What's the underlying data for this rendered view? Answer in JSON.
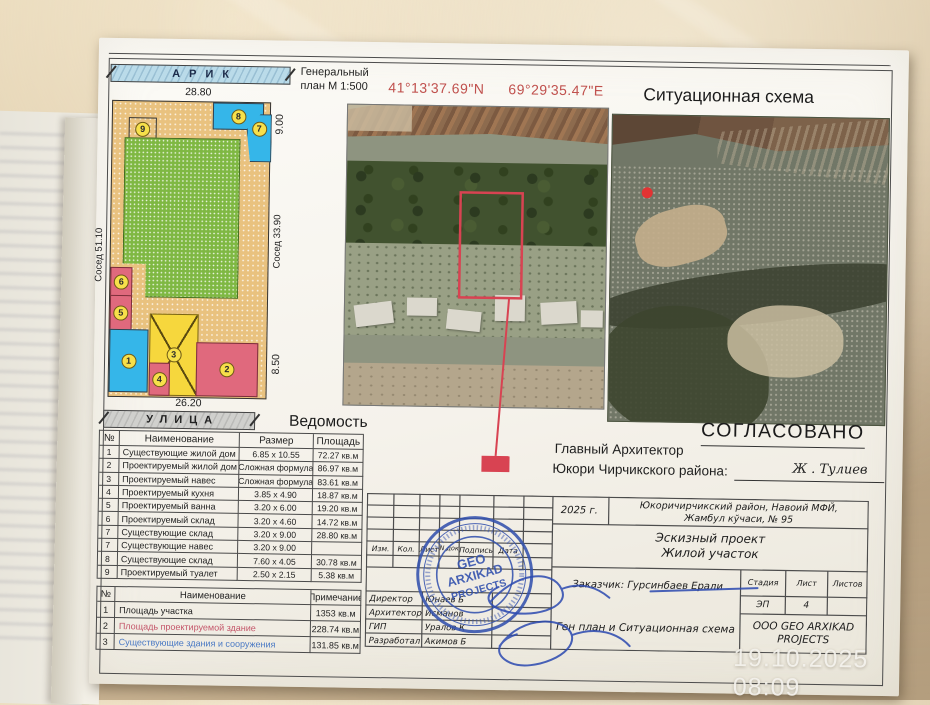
{
  "photo": {
    "timestamp": "19.10.2025 08:09"
  },
  "header": {
    "genplan_line1": "Генеральный",
    "genplan_line2": "план М 1:500",
    "coord_n": "41°13'37.69\"N",
    "coord_e": "69°29'35.47\"E",
    "situational_title": "Ситуационная схема"
  },
  "plan": {
    "canal_label": "АРИК",
    "street_label": "УЛИЦА",
    "dim_top": "28.80",
    "dim_left": "Сосед 51.10",
    "dim_right_top": "9.00",
    "dim_right_mid": "Сосед 33.90",
    "dim_right_bottom": "8.50",
    "dim_bottom": "26.20",
    "blocks": {
      "n1": "1",
      "n2": "2",
      "n3": "3",
      "n4": "4",
      "n5": "5",
      "n6": "6",
      "n7": "7",
      "n8": "8",
      "n9": "9"
    }
  },
  "tables": {
    "vedomost": {
      "title": "Ведомость",
      "headers": [
        "№",
        "Наименование",
        "Размер",
        "Площадь"
      ],
      "rows": [
        {
          "num": "1",
          "name": "Существующие жилой дом",
          "size": "6.85 x 10.55",
          "area": "72.27  кв.м"
        },
        {
          "num": "2",
          "name": "Проектируемый жилой дом",
          "size": "Сложная формула",
          "area": "86.97  кв.м"
        },
        {
          "num": "3",
          "name": "Проектируемый навес",
          "size": "Сложная формула",
          "area": "83.61  кв.м"
        },
        {
          "num": "4",
          "name": "Проектируемый кухня",
          "size": "3.85 x 4.90",
          "area": "18.87  кв.м"
        },
        {
          "num": "5",
          "name": "Проектируемый ванна",
          "size": "3.20 x 6.00",
          "area": "19.20  кв.м"
        },
        {
          "num": "6",
          "name": "Проектируемый склад",
          "size": "3.20 x 4.60",
          "area": "14.72  кв.м"
        },
        {
          "num": "7",
          "name": "Существующие склад",
          "size": "3.20 x 9.00",
          "area": "28.80  кв.м"
        },
        {
          "num": "7",
          "name": "Существующие навес",
          "size": "3.20 x 9.00",
          "area": ""
        },
        {
          "num": "8",
          "name": "Существующие склад",
          "size": "7.60 x 4.05",
          "area": "30.78  кв.м"
        },
        {
          "num": "9",
          "name": "Проектируемый туалет",
          "size": "2.50 x 2.15",
          "area": "5.38  кв.м"
        }
      ]
    },
    "areas": {
      "headers": [
        "№",
        "Наименование",
        "Примечание"
      ],
      "rows": [
        {
          "num": "1",
          "name": "Площадь участка",
          "note": "1353 кв.м"
        },
        {
          "num": "2",
          "name": "Площадь проектируемой здание",
          "note": "228.74 кв.м"
        },
        {
          "num": "3",
          "name": "Существующие здания и сооружения",
          "note": "131.85 кв.м"
        }
      ]
    }
  },
  "approval": {
    "stamp_word": "СОГЛАСОВАНО",
    "line1": "Главный Архитектор",
    "line2": "Юкори  Чирчикского района:",
    "signature": "Ж . Тулиев"
  },
  "title_block": {
    "year": "2025 г.",
    "address_line1": "Юкоричирчикский район, Навоий МФЙ,",
    "address_line2": "Жамбул кўчаси, № 95",
    "project_line1": "Эскизный проект",
    "project_line2": "Жилой участок",
    "client": "Заказчик: Гурсинбаев Ерали",
    "sheet_title": "Ген план и Ситуационная схема",
    "company_line1": "ООО GEO ARXIKAD",
    "company_line2": "PROJECTS",
    "cols": [
      "Изм.",
      "Кол.",
      "Лист",
      "N док",
      "Подпись",
      "Дата"
    ],
    "roles": [
      {
        "role": "Директор",
        "name": "Юнаев Б"
      },
      {
        "role": "Архитектор",
        "name": "Исманов"
      },
      {
        "role": "ГИП",
        "name": "Уралов К"
      },
      {
        "role": "Разработал",
        "name": "Акимов Б"
      }
    ],
    "stage": {
      "headers": [
        "Стадия",
        "Лист",
        "Листов"
      ],
      "values": [
        "ЭП",
        "4",
        ""
      ]
    }
  },
  "stamp": {
    "line1": "GEO",
    "line2": "ARXIKAD",
    "line3": "PROJECTS"
  },
  "colors": {
    "annotation_red": "#d84352",
    "coord_red": "#c0504d",
    "stamp_blue": "#3452ae",
    "canal_blue": "#badbe9",
    "plan_tan": "#e9c27f",
    "plan_green": "#7fb843",
    "block_blue": "#35b6e9",
    "block_pink": "#e0697d",
    "block_yellow": "#f6d73d"
  }
}
